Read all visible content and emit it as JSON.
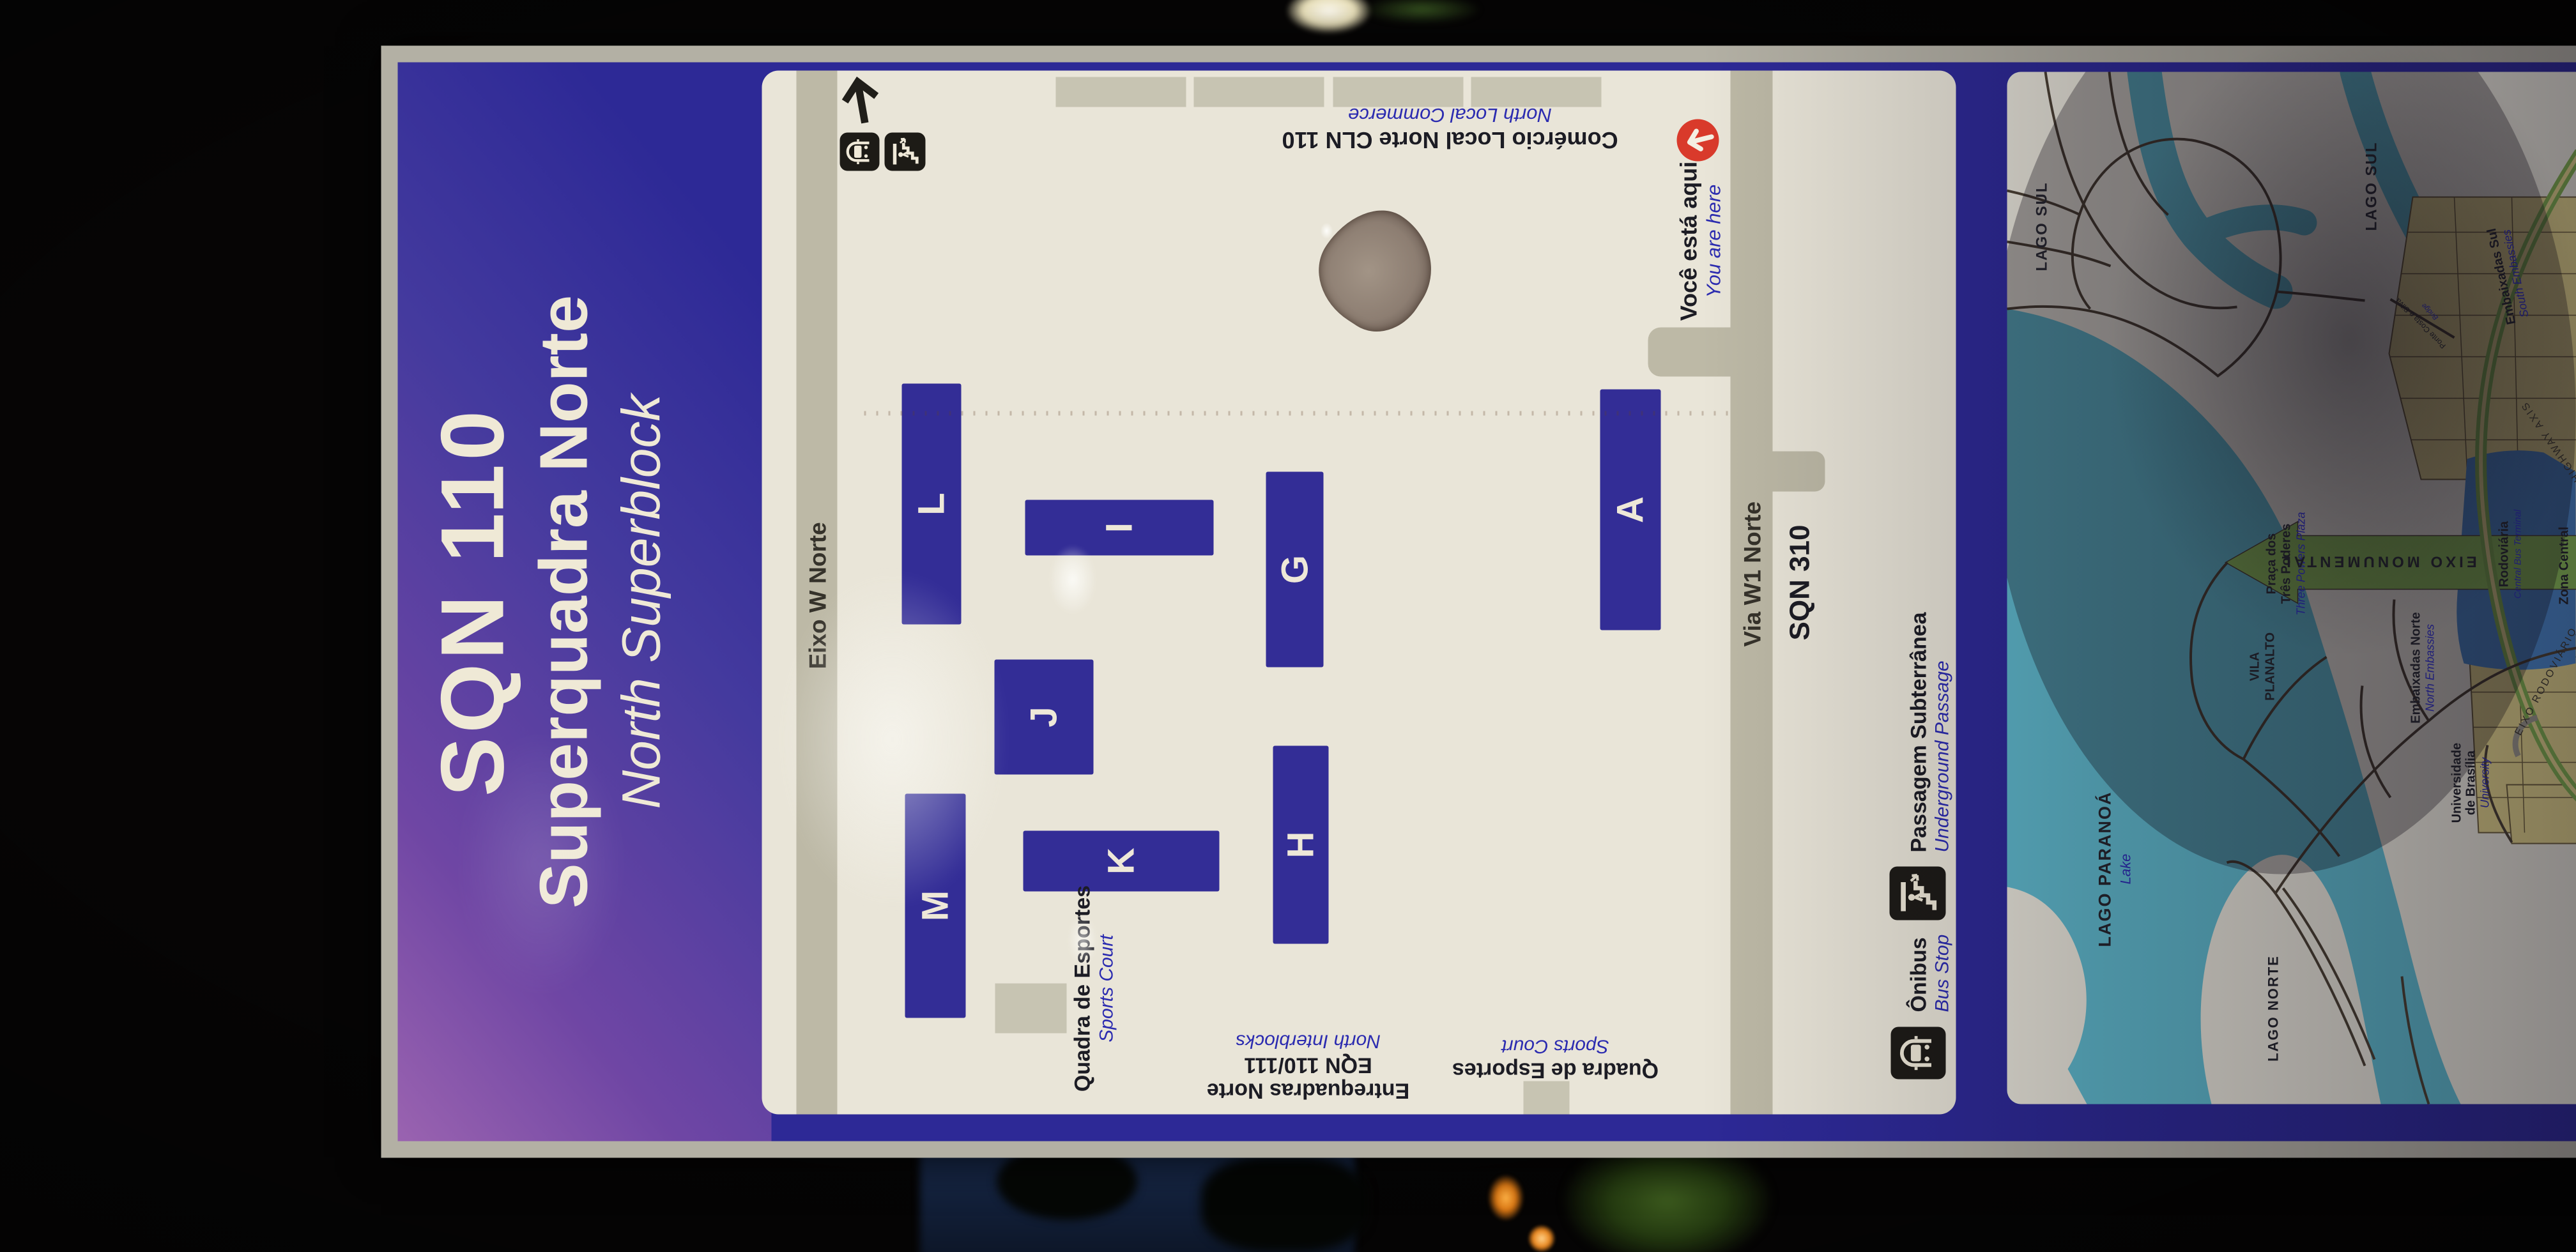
{
  "colors": {
    "header_purple": "#9a63b0",
    "header_blue": "#2d2996",
    "panel_white": "#e9e5d8",
    "block_indigo": "#332d96",
    "road_gray": "#bdb9a6",
    "water_cyan": "#5fb9cc",
    "land_white": "#e9e6da",
    "district_yellow": "#e0d18a",
    "axis_green": "#8cbf58",
    "central_blue": "#4a86c8",
    "you_are_here_red": "#d93a2b"
  },
  "icons": {
    "north_arrow": "north-arrow",
    "bus": "bus-front",
    "underground": "stairs-person-down",
    "you_are_here": "arrow-up-in-red-circle"
  },
  "sign": {
    "header": {
      "code": "SQN 110",
      "title_pt": "Superquadra Norte",
      "title_en": "North Superblock"
    },
    "map": {
      "road_top": "Eixo W Norte",
      "road_bottom": "Via W1 Norte",
      "neighbor_block": "SQN 310",
      "blocks": [
        "M",
        "L",
        "K",
        "J",
        "I",
        "H",
        "G",
        "A"
      ],
      "commerce": {
        "pt": "Comércio Local Norte CLN 110",
        "en": "North Local Commerce"
      },
      "interblocks": {
        "pt": "Entrequadras Norte",
        "code": "EQN 110/111",
        "en": "North Interblocks"
      },
      "sports_court": {
        "pt": "Quadra de Esportes",
        "en": "Sports Court"
      },
      "sports_court_2": {
        "pt": "Quadra de Esportes",
        "en": "Sports Court"
      },
      "you_are_here": {
        "pt": "Você está aqui",
        "en": "You are here"
      },
      "legend_bus": {
        "pt": "Ônibus",
        "en": "Bus Stop"
      },
      "legend_underground": {
        "pt": "Passagem Subterrânea",
        "en": "Underground Passage"
      }
    },
    "city_map": {
      "lago_sul": "LAGO SUL",
      "lago_sul_2": "LAGO SUL",
      "lago_paranoa": {
        "pt": "LAGO PARANOÁ",
        "en": "Lake"
      },
      "lago_norte": "LAGO NORTE",
      "vila_planalto": {
        "l1": "VILA",
        "l2": "PLANALTO"
      },
      "praca": {
        "l1": "Praça dos",
        "l2": "Três Poderes",
        "en": "Three Powers Plaza"
      },
      "embaixadas_norte": {
        "pt": "Embaixadas Norte",
        "en": "North Embassies"
      },
      "embaixadas_sul": {
        "pt": "Embaixadas Sul",
        "en": "South Embassies"
      },
      "universidade": {
        "l1": "Universidade",
        "l2": "de Brasília",
        "en": "University"
      },
      "rodoviaria": {
        "pt": "Rodoviária",
        "en": "Central Bus Terminal"
      },
      "zona_central": "Zona Central",
      "eixo_monumental": "EIXO MONUMENTAL",
      "eixo_rodoviario": "EIXO RODOVIÁRIO",
      "highway_axis": "HIGHWAY AXIS",
      "ponte": {
        "pt": "Ponte Costa e Silva",
        "en": "Bridge"
      }
    }
  }
}
